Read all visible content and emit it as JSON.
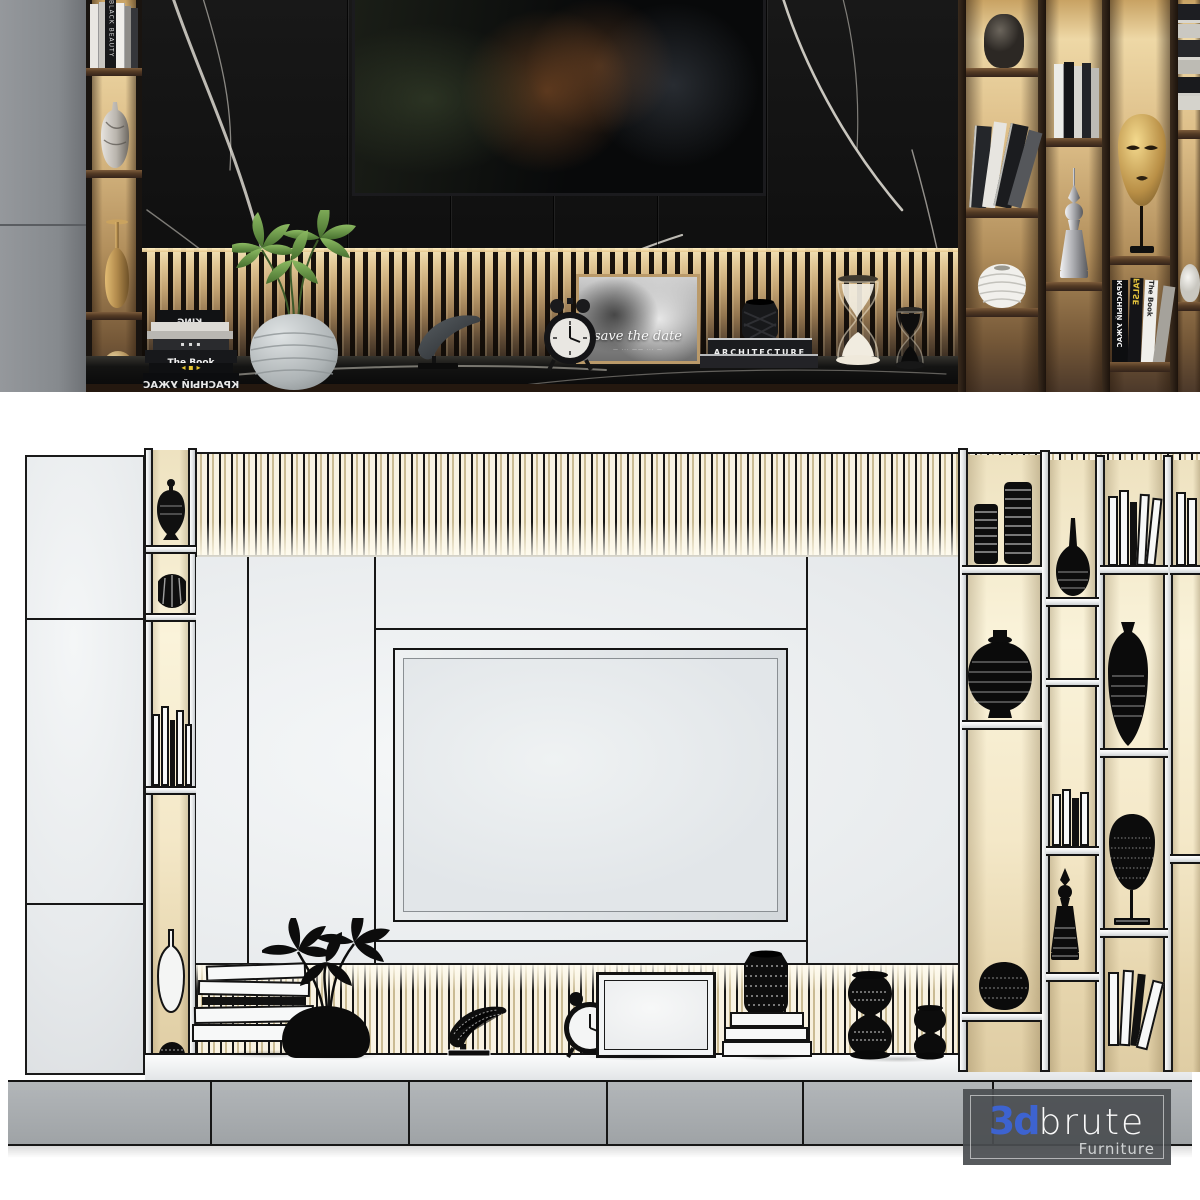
{
  "top_render": {
    "shelf_books_left": {
      "spine": "BLACK BEAUTY"
    },
    "book_stack": {
      "spine_king": "KING",
      "spine_the_book": "The Book",
      "spine_red": "КРАСНЫЙ УЖАС"
    },
    "photo_frame": {
      "caption": "save the date"
    },
    "coffee_table_books": {
      "spine": "ARCHITECTURE"
    },
    "right_shelf_books": {
      "spine_red": "КРАСНЫЙ УЖАС",
      "spine_false": "FALSE",
      "spine_the_book": "The Book"
    }
  },
  "watermark": {
    "brand_prefix": "3d",
    "brand_suffix": "brute",
    "subtitle": "Furniture"
  },
  "palette": {
    "logo_blue": "#3d63d0",
    "backlight_warm": "#e9d2a0",
    "marble_black": "#141414",
    "cabinet_gray": "#8b8f93",
    "drawer_gray": "#a9adb0",
    "wire_line_black": "#1a1a1a"
  }
}
